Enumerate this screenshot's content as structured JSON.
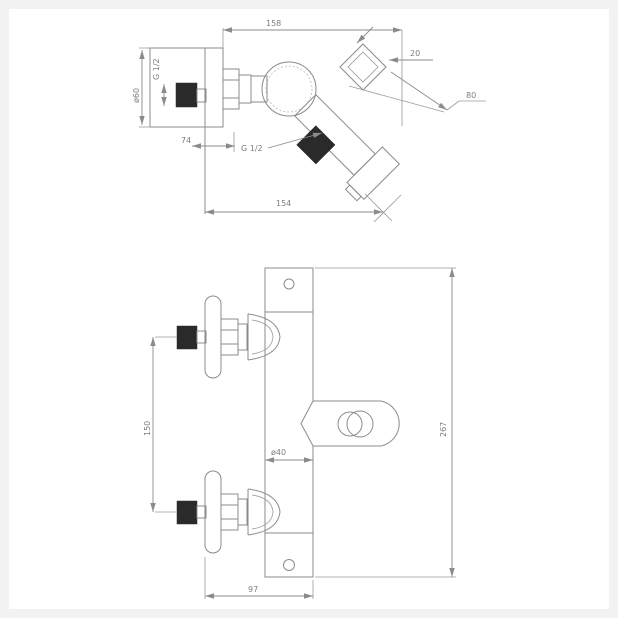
{
  "drawing": {
    "side_view": {
      "dim_overall_width": "158",
      "dim_shower_outlet_offset": "20",
      "dim_spout_reach": "80",
      "dim_escutcheon_diameter": "ø60",
      "label_inlet_thread": "G 1/2",
      "dim_wall_offset": "74",
      "label_outlet_thread": "G 1/2",
      "dim_bottom_width": "154"
    },
    "front_view": {
      "dim_inlet_spacing": "150",
      "dim_overall_height": "267",
      "dim_body_diameter": "ø40",
      "dim_base_width": "97"
    },
    "colors": {
      "line": "#8b8b8b",
      "text": "#7d7d7d",
      "dark_fill": "#2a2a2a",
      "paper": "#ffffff",
      "frame": "#f2f2f2"
    }
  }
}
